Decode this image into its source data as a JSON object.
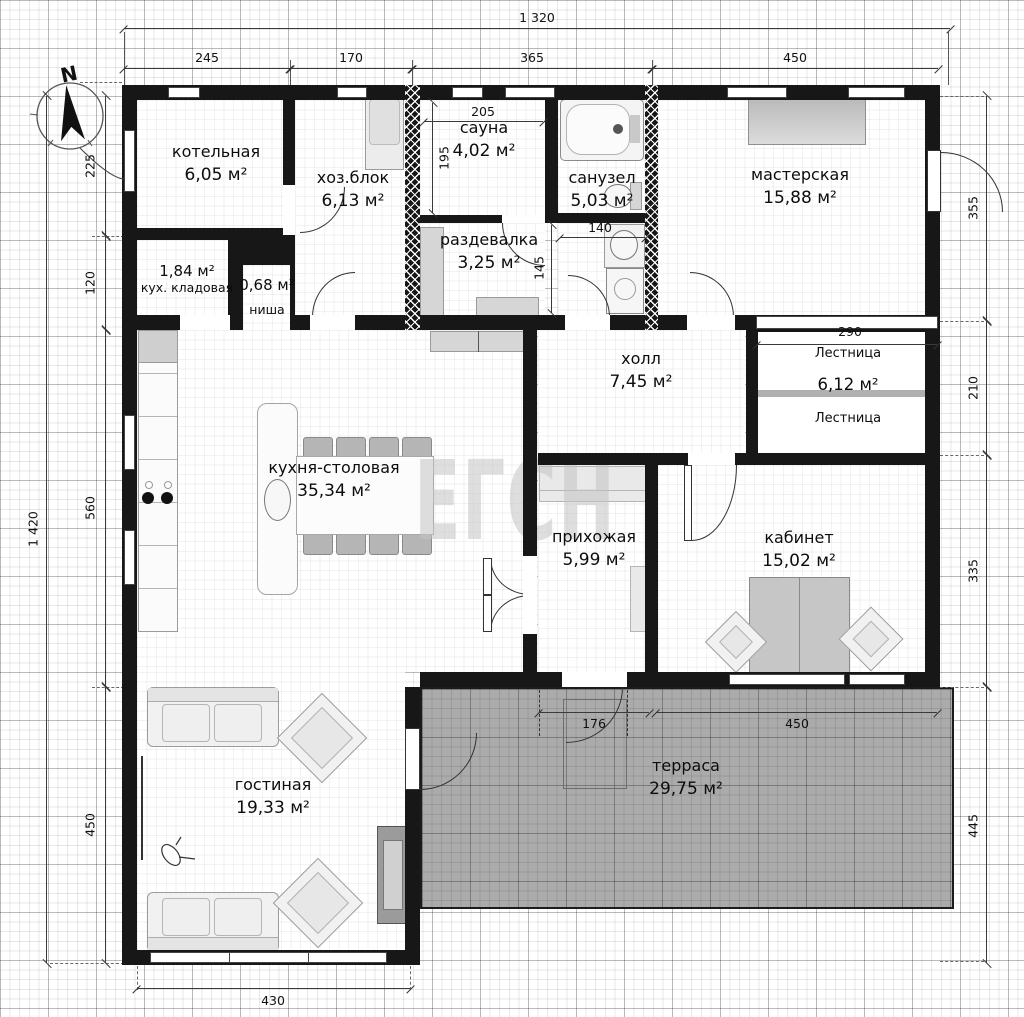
{
  "watermark": "ЕГСН",
  "compass": {
    "label": "N"
  },
  "rooms": {
    "kotelnaya": {
      "name": "котельная",
      "area": "6,05 м²"
    },
    "hozblok": {
      "name": "хоз.блок",
      "area": "6,13 м²"
    },
    "sauna": {
      "name": "сауна",
      "area": "4,02 м²"
    },
    "sanuzel": {
      "name": "санузел",
      "area": "5,03 м²"
    },
    "masterskaya": {
      "name": "мастерская",
      "area": "15,88 м²"
    },
    "kladovaya": {
      "name": "кух. кладовая",
      "area": "1,84 м²"
    },
    "nisha": {
      "name": "ниша",
      "area": "0,68 м²"
    },
    "razdevalka": {
      "name": "раздевалка",
      "area": "3,25 м²"
    },
    "holl": {
      "name": "холл",
      "area": "7,45 м²"
    },
    "lestnitsa": {
      "name": "Лестница",
      "area": "6,12 м²",
      "name2": "Лестница"
    },
    "kuhnya": {
      "name": "кухня-столовая",
      "area": "35,34 м²"
    },
    "prihozhaya": {
      "name": "прихожая",
      "area": "5,99 м²"
    },
    "kabinet": {
      "name": "кабинет",
      "area": "15,02 м²"
    },
    "gostinaya": {
      "name": "гостиная",
      "area": "19,33 м²"
    },
    "terrasa": {
      "name": "терраса",
      "area": "29,75 м²"
    }
  },
  "dimensions": {
    "top_total": "1 320",
    "top": [
      "245",
      "170",
      "365",
      "450"
    ],
    "left_total": "1 420",
    "left": [
      "225",
      "120",
      "560",
      "450"
    ],
    "right": [
      "355",
      "210",
      "335",
      "445"
    ],
    "bottom": "430",
    "inner": {
      "sauna_w": "205",
      "sauna_h": "195",
      "wc_w": "140",
      "razdevalka_open": "145",
      "stairs_w": "290",
      "terrace_left": "176",
      "terrace_right": "450"
    }
  },
  "colors": {
    "wall": "#171717",
    "terrace_fill": "#ababab",
    "furniture_gray": "#b5b5b5",
    "accent_text": "#0d0d0d"
  }
}
